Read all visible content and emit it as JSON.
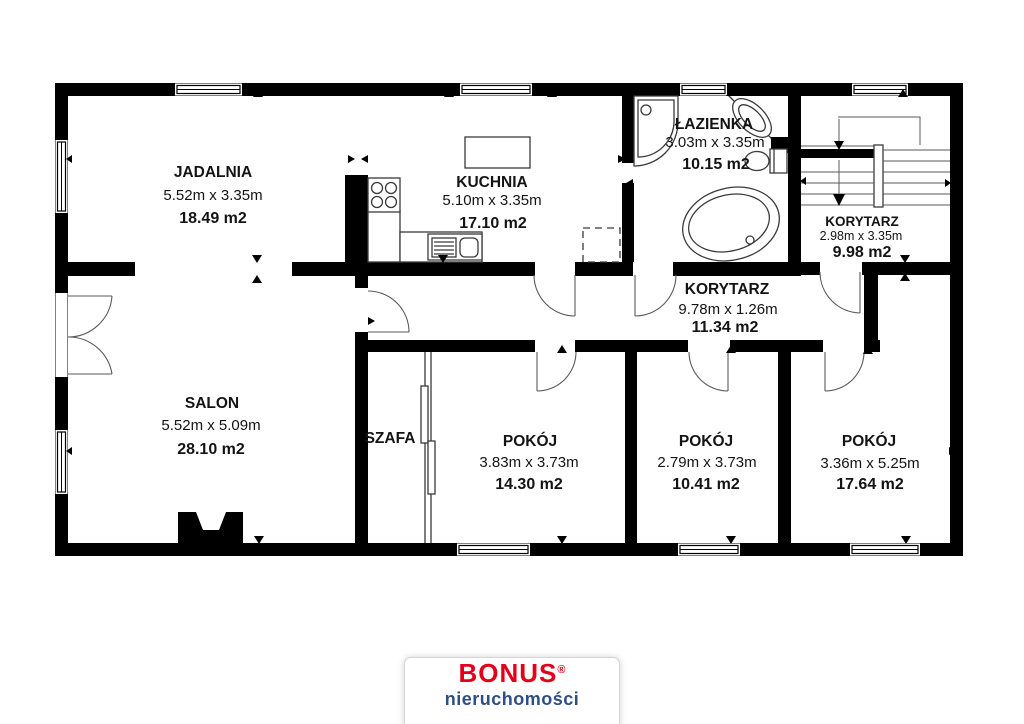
{
  "plan": {
    "rooms": {
      "jadalnia": {
        "name": "JADALNIA",
        "dims": "5.52m x 3.35m",
        "area": "18.49 m2"
      },
      "kuchnia": {
        "name": "KUCHNIA",
        "dims": "5.10m x 3.35m",
        "area": "17.10 m2"
      },
      "lazienka": {
        "name": "ŁAZIENKA",
        "dims": "3.03m x 3.35m",
        "area": "10.15 m2"
      },
      "korytarz_gorny": {
        "name": "KORYTARZ",
        "dims": "2.98m x 3.35m",
        "area": "9.98 m2"
      },
      "korytarz": {
        "name": "KORYTARZ",
        "dims": "9.78m x 1.26m",
        "area": "11.34 m2"
      },
      "salon": {
        "name": "SALON",
        "dims": "5.52m x 5.09m",
        "area": "28.10 m2"
      },
      "szafa": {
        "name": "SZAFA"
      },
      "pokoj_1": {
        "name": "POKÓJ",
        "dims": "3.83m x 3.73m",
        "area": "14.30 m2"
      },
      "pokoj_2": {
        "name": "POKÓJ",
        "dims": "2.79m x 3.73m",
        "area": "10.41 m2"
      },
      "pokoj_3": {
        "name": "POKÓJ",
        "dims": "3.36m x 5.25m",
        "area": "17.64 m2"
      }
    },
    "colors": {
      "wall": "#000000",
      "background": "#ffffff",
      "fixture_line": "#3a3a3a"
    }
  },
  "logo": {
    "brand": "BONUS",
    "registered": "®",
    "tagline": "nieruchomości",
    "brand_color": "#e2001a",
    "tagline_color": "#2d4e86"
  }
}
